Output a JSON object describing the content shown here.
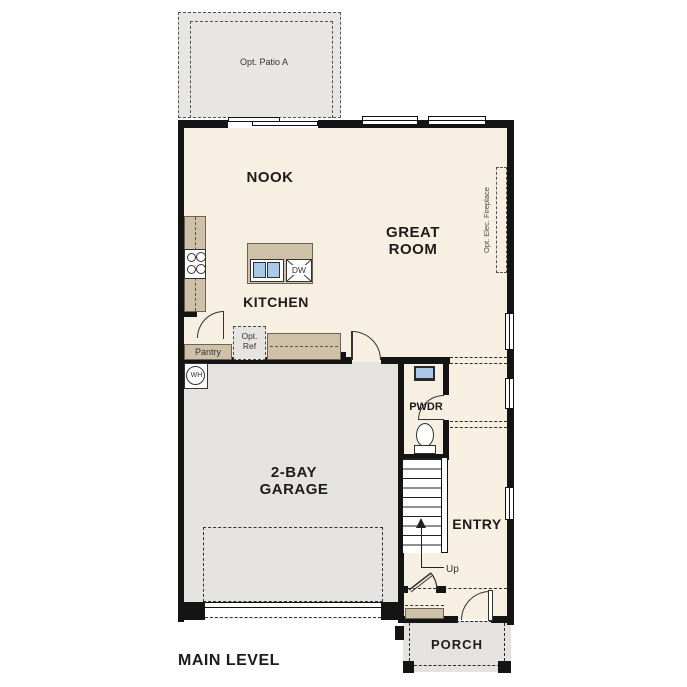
{
  "title": "MAIN LEVEL",
  "labels": {
    "patio": "Opt. Patio A",
    "nook": "NOOK",
    "great_room": "GREAT ROOM",
    "fireplace": "Opt. Elec. Fireplace",
    "kitchen": "KITCHEN",
    "dishwasher": "DW",
    "opt_ref": "Opt. Ref",
    "pantry": "Pantry",
    "water_heater": "WH",
    "garage": "2-BAY GARAGE",
    "pwdr": "PWDR",
    "entry": "ENTRY",
    "up": "Up",
    "porch": "PORCH"
  },
  "colors": {
    "wall": "#141414",
    "floor": "#f7efe1",
    "garage": "#e4e3e0",
    "patio": "#e7e6e3",
    "porch": "#e4e3e0",
    "counter": "#cfc1a8",
    "sink": "#aac8e8",
    "line": "#333333"
  }
}
